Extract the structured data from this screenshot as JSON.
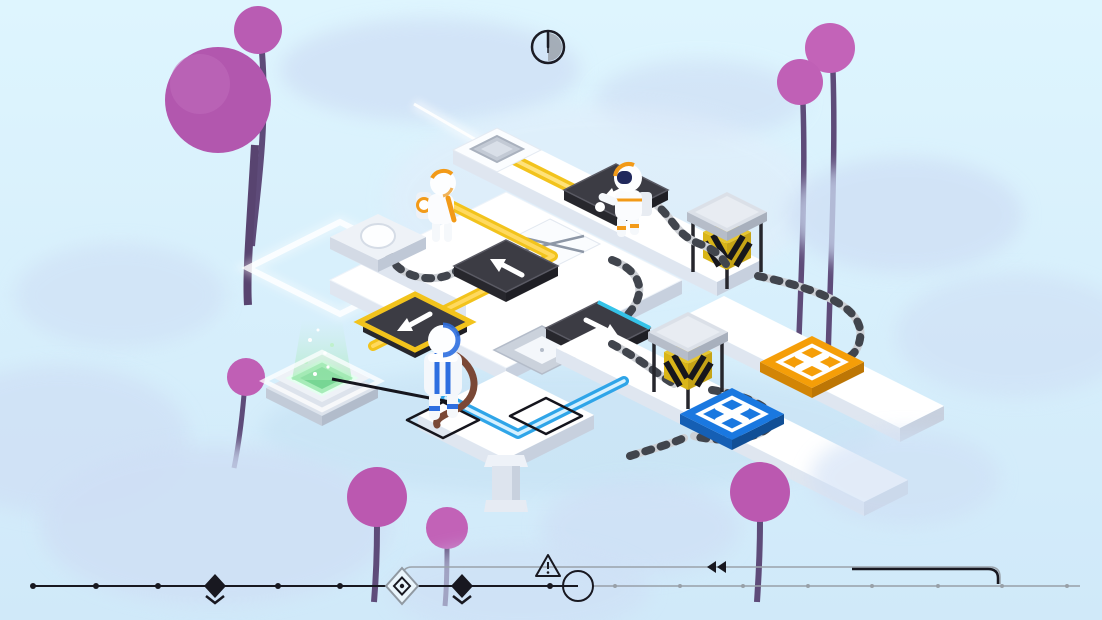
{
  "app": {
    "title": "Isometric time-puzzle level",
    "scene": "sky world with clay trees and floating white walkways"
  },
  "hud": {
    "timer": {
      "icon": "half-clock-icon",
      "state": "half elapsed",
      "ring_color": "#1b1b24",
      "fill_color": "#9ba2ab"
    }
  },
  "board": {
    "platform_top_color": "#ffffff",
    "platform_side_colors": [
      "#dfe6f0",
      "#c7d0de"
    ],
    "tiles": [
      {
        "name": "start-pad",
        "type": "raised pad with gray socket and white light beam"
      },
      {
        "name": "button-tile",
        "type": "raised tile with round white pressure button"
      },
      {
        "name": "arrow-tile-north",
        "type": "dark direction tile",
        "arrow": "up-left",
        "color": "#3c3c44"
      },
      {
        "name": "arrow-tile-under-astronaut",
        "type": "dark direction tile",
        "arrow": "left",
        "color": "#3c3c44"
      },
      {
        "name": "arrow-tile-southwest",
        "type": "dark direction tile",
        "arrow": "down-left",
        "color": "#3c3c44",
        "highlight_ring": "#f2c31c"
      },
      {
        "name": "arrow-tile-southeast",
        "type": "dark direction tile",
        "arrow": "down-right",
        "color": "#3c3c44",
        "edge_highlight": "#35c3e8"
      },
      {
        "name": "crossed-tile",
        "type": "white tile with thin gray X mark"
      },
      {
        "name": "hatch-plate-tile",
        "type": "gray panel with white square lid and connector tab"
      },
      {
        "name": "goal-pad-orange",
        "symbol": "X",
        "color": "#f59e08",
        "outline": "#ffffff"
      },
      {
        "name": "goal-pad-blue",
        "symbol": "X",
        "color": "#1a78e0",
        "outline": "#ffffff"
      },
      {
        "name": "teleporter-pad",
        "color": "#a6ecb8",
        "effect": "rising green particle beam"
      },
      {
        "name": "footprint-marker-left",
        "type": "black outline square on tile"
      },
      {
        "name": "footprint-marker-right",
        "type": "black outline square on tile"
      },
      {
        "name": "spawn-zone-outline",
        "type": "glowing white diamond on ground with light streak"
      }
    ],
    "props": [
      {
        "name": "hazard-lift-upper",
        "type": "caged lift",
        "stripe_colors": [
          "#e7c62e",
          "#17171c"
        ],
        "cap_color": "#dbe0e8"
      },
      {
        "name": "hazard-lift-lower",
        "type": "caged lift",
        "stripe_colors": [
          "#e7c62e",
          "#17171c"
        ],
        "cap_color": "#dbe0e8"
      },
      {
        "name": "ribbed-cables",
        "count": 7,
        "base_color": "#cdd0d5",
        "band_color": "#41454d"
      },
      {
        "name": "support-pillar",
        "color": "#dde4ee"
      }
    ],
    "routes": [
      {
        "name": "yellow-route",
        "color": "#f2c31c",
        "from": "start pad and orange astronaut",
        "to": "southwest arrow tile"
      },
      {
        "name": "blue-route",
        "color": "#2fa5e8",
        "from": "southeast arrow tile",
        "to": "blue astronaut corner"
      }
    ],
    "characters": [
      {
        "name": "astronaut-orange",
        "suit_accent": "#f29a18",
        "position": "upper-left walkway end"
      },
      {
        "name": "astronaut-white-orange",
        "suit_accent": "#f29a18",
        "visor": "#20285c",
        "position": "standing on left-arrow tile"
      },
      {
        "name": "astronaut-blue",
        "suit_accent": "#2e6fe0",
        "tether_color": "#7a4836",
        "position": "lower walkway, back turned"
      }
    ]
  },
  "scenery": {
    "sky_top": "#def5fe",
    "sky_bottom": "#d0e9f9",
    "cloud_color": "#cfdff5",
    "trees": {
      "foliage_colors": [
        "#b257ae",
        "#c363b8"
      ],
      "stem_color": "#5e4b79",
      "count": 8
    }
  },
  "timeline": {
    "past_line_color": "#181820",
    "future_line_color": "#98a0a8",
    "markers": [
      {
        "type": "tick-dot"
      },
      {
        "type": "tick-dot"
      },
      {
        "type": "tick-dot"
      },
      {
        "type": "event-diamond"
      },
      {
        "type": "tick-dot"
      },
      {
        "type": "tick-dot"
      },
      {
        "type": "current-position-double-diamond"
      },
      {
        "type": "event-diamond"
      },
      {
        "type": "tick-dot"
      },
      {
        "type": "playhead-circle"
      },
      {
        "type": "future-tick-dots",
        "count": 8
      }
    ],
    "icons": {
      "warning": "alert-triangle-icon",
      "rewind": "double-left-arrow-icon"
    },
    "loop": "gray rewind loop rising from current-position marker to a future point, darkened on its right span"
  }
}
